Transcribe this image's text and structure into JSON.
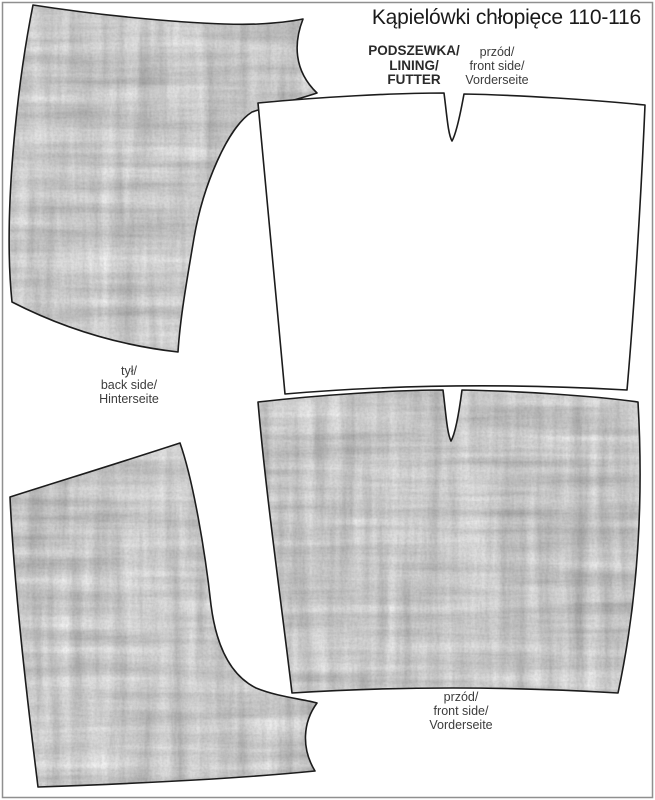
{
  "title": "Kąpielówki chłopięce 110-116",
  "labels": {
    "lining": {
      "lines": [
        "PODSZEWKA/",
        "LINING/",
        "FUTTER"
      ]
    },
    "front_top": {
      "lines": [
        "przód/",
        "front side/",
        "Vorderseite"
      ]
    },
    "back": {
      "lines": [
        "tył/",
        "back side/",
        "Hinterseite"
      ]
    },
    "front_bottom": {
      "lines": [
        "przód/",
        "front side/",
        "Vorderseite"
      ]
    }
  },
  "colors": {
    "background": "#ffffff",
    "outline": "#1c1c1c",
    "frame": "#8f8f8f",
    "title_text": "#1a1a1a",
    "label_text": "#3c3c3c",
    "fabric_light": "#e9e9e9",
    "fabric_dark": "#2e2e2e"
  }
}
